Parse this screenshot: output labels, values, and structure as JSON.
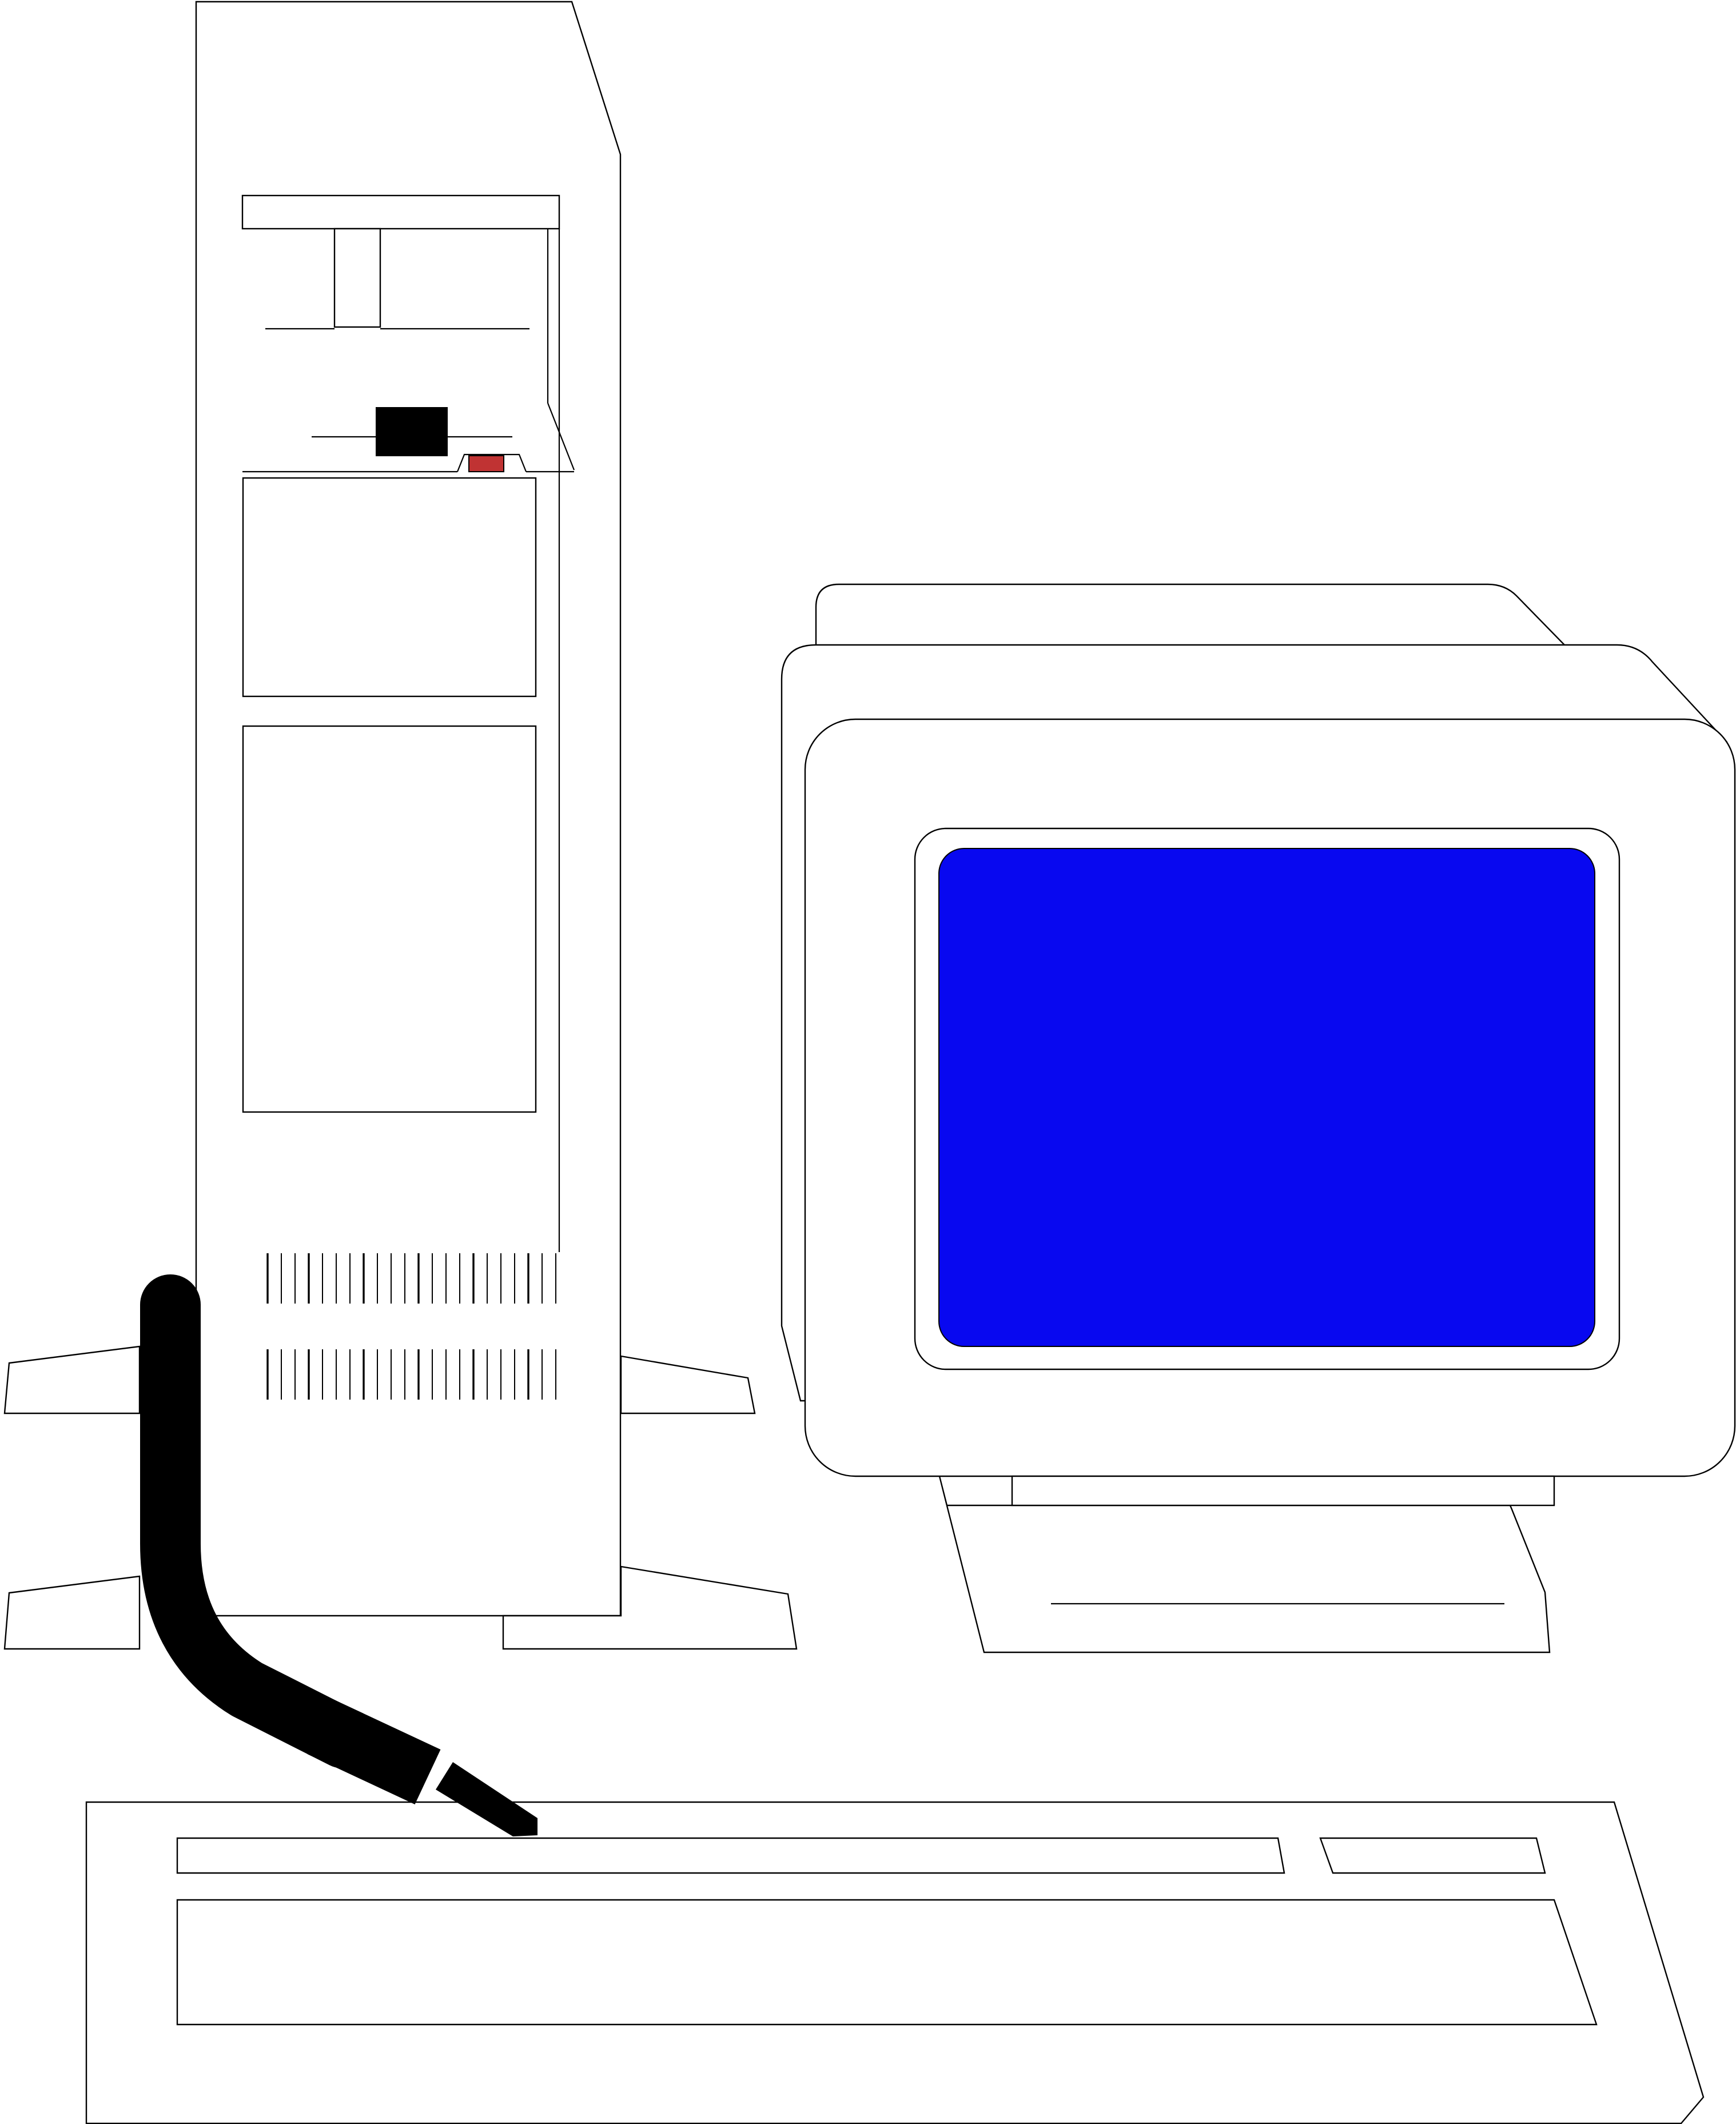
{
  "illustration": {
    "description": "Line-art clip art of a desktop computer system: vertical tower case on a floor stand, CRT monitor with blue screen on a swivel base, keyboard, and a thick black cable running from the tower to the keyboard",
    "background": "#ffffff"
  },
  "colors": {
    "outline_black": "#000000",
    "body_white": "#ffffff",
    "screen_blue": "#0808f0",
    "led_red": "#c03333",
    "button_black": "#000000",
    "cable_black": "#000000"
  },
  "components": {
    "tower": {
      "label": "tower case",
      "parts": [
        "top band",
        "drive bay tab",
        "floppy slot line",
        "power button",
        "power LED",
        "notch",
        "upper bay panel",
        "lower bay panel",
        "upper vent grille",
        "lower vent grille",
        "stand feet"
      ]
    },
    "monitor": {
      "label": "CRT monitor",
      "parts": [
        "back shell",
        "middle shell",
        "front bezel",
        "blue screen",
        "swivel plate",
        "stand base"
      ]
    },
    "keyboard": {
      "label": "keyboard",
      "parts": [
        "function key row",
        "nav key block",
        "main key area"
      ]
    },
    "cable": {
      "label": "keyboard cable with plug"
    }
  },
  "vents": {
    "ticks_per_band": 22,
    "bands": 2
  }
}
